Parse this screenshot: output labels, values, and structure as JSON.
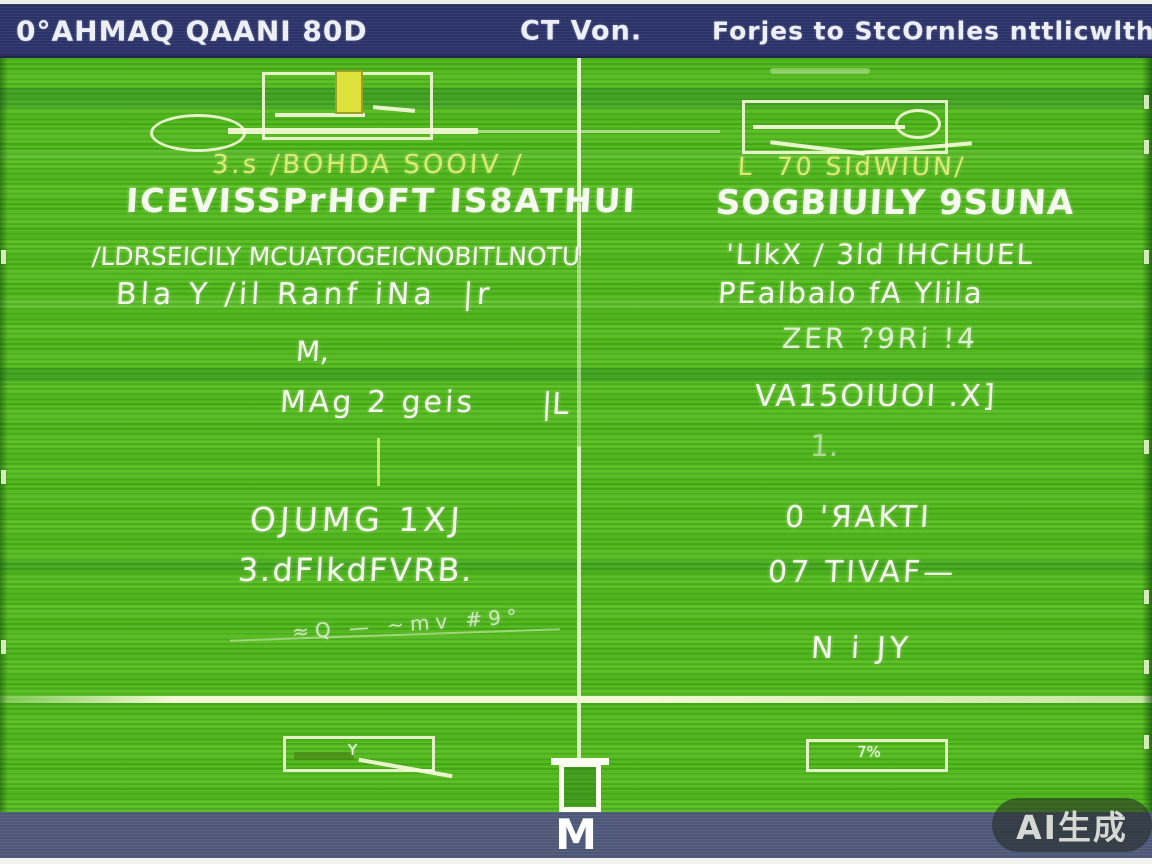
{
  "colors": {
    "topbar_bg": "#2b3268",
    "field_green": "#4fb71d",
    "bottombar_bg": "#4d5878",
    "marking_white": "#f3f9d4",
    "card_yellow": "#dfe23c",
    "text_white": "#f5faee",
    "text_yellow_green": "#dcec6a"
  },
  "top_bar": {
    "left_title": "0°AHMAQ QAANI 80D",
    "center_title": "CT Von.",
    "right_title": "Forjes to StcOrnles nttlicwlths"
  },
  "field": {
    "left_column": {
      "subtitle": "3.s /BOHDA SOOIV /",
      "title": "ICEVISSPrHOFT IS8ATHUI",
      "line3": "/LDRSEICILY MCUATOGEICNOBITLNOTU",
      "line4": "Bla Y /il Ranf iNa  |r",
      "line5": "M,",
      "line6": "MAg 2 geis",
      "line6_mark": "|L",
      "line7": "OJUMG 1XJ",
      "line8": "3.dFlkdFVRB.",
      "line9": "≈Q — ~mv #9°"
    },
    "right_column": {
      "subtitle": "L  70 SIdWIUN/",
      "title": "SOGBIUILY 9SUNA",
      "line3": "'LIkX / 3ld IHCHUEL",
      "line4": "PEalbalo fA Ylila",
      "line5": "ZER ?9Ri !4",
      "line6": "VA15OIUOI .X]",
      "line7": "1.",
      "line8": "0 'ЯAKTI",
      "line9": "07 TIVAF—",
      "line10": "N i JY"
    },
    "bottom_left_box_label": "Y",
    "bottom_right_box_label": "7%"
  },
  "bottom_bar": {
    "label": "M"
  },
  "watermark": {
    "label": "AI生成"
  }
}
